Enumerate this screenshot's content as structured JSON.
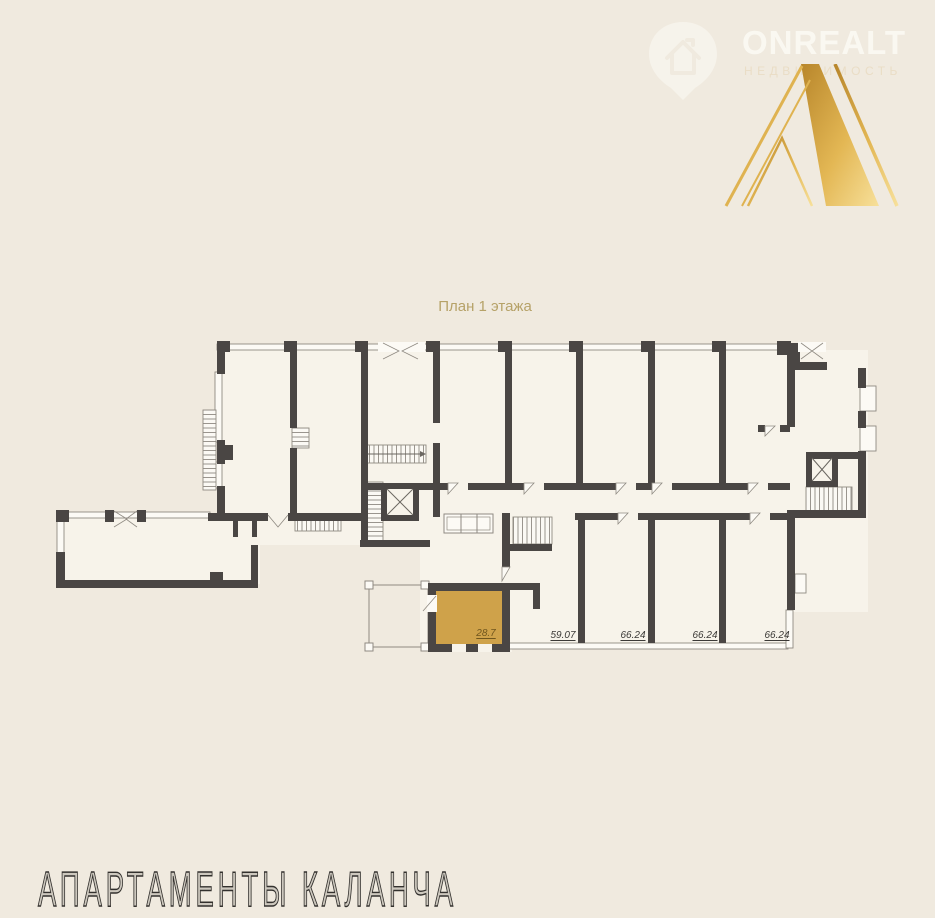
{
  "canvas": {
    "background": "#f0eadf"
  },
  "watermark": {
    "brand": "ONREALT",
    "subtitle": "НЕДВИЖИМОСТЬ",
    "icon": "house-pin-icon"
  },
  "logo": {
    "letter": "А",
    "gradient_from": "#b8862b",
    "gradient_to": "#f7e09a"
  },
  "plan": {
    "title": "План 1 этажа",
    "highlight": {
      "label": "28.7",
      "fill": "#cfa24a",
      "label_color": "#6f551d"
    },
    "rooms": [
      {
        "label": "59.07"
      },
      {
        "label": "66.24"
      },
      {
        "label": "66.24"
      },
      {
        "label": "66.24"
      }
    ],
    "colors": {
      "wall": "#4a4644",
      "interior": "#f7f3ea",
      "thin_line": "#8f8a82",
      "title": "#b6a268",
      "label": "#3b3936"
    }
  },
  "footer": {
    "title": "АПАРТАМЕНТЫ КАЛАНЧА"
  }
}
